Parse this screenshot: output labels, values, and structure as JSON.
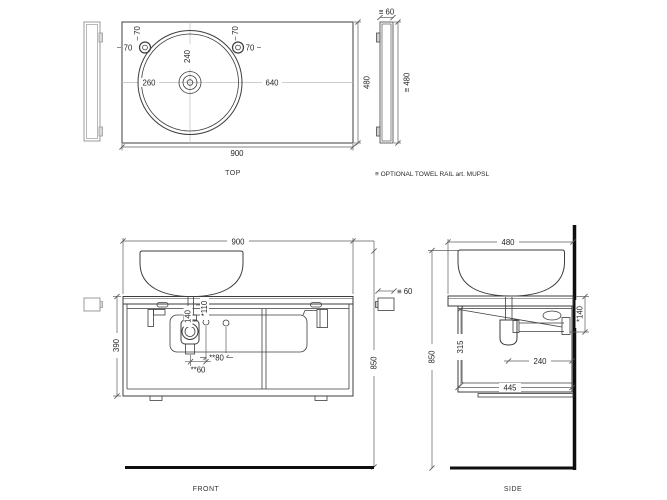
{
  "top_view": {
    "label": "TOP",
    "width": "900",
    "depth": "480",
    "basin_from_left": "260",
    "basin_from_right": "640",
    "basin_from_top": "240",
    "faucet_left_top": "70",
    "faucet_left_side": "70",
    "faucet_right_top": "70",
    "faucet_right_side": "70"
  },
  "towel_rail": {
    "thickness": "≡ 60",
    "length": "≡ 480",
    "front_thickness": "≡ 60",
    "footnote": "≡ OPTIONAL TOWEL RAIL art. MUPSL"
  },
  "front_view": {
    "label": "FRONT",
    "width": "900",
    "cabinet_height": "390",
    "overall_height": "850",
    "trap_depth": "140",
    "outlet_depth": "*110",
    "outlet_spacing": "**80",
    "trap_offset": "**60"
  },
  "side_view": {
    "label": "SIDE",
    "depth": "480",
    "overall_height": "850",
    "internal_height": "315",
    "trap_to_wall": "240",
    "cabinet_depth": "445",
    "outlet_drop": "*140"
  },
  "colors": {
    "line": "#3d3d3d",
    "dim": "#5d5d5d",
    "accessory_gray": "#9b9b9b",
    "datum_black": "#0f0f0f",
    "background": "#ffffff"
  }
}
